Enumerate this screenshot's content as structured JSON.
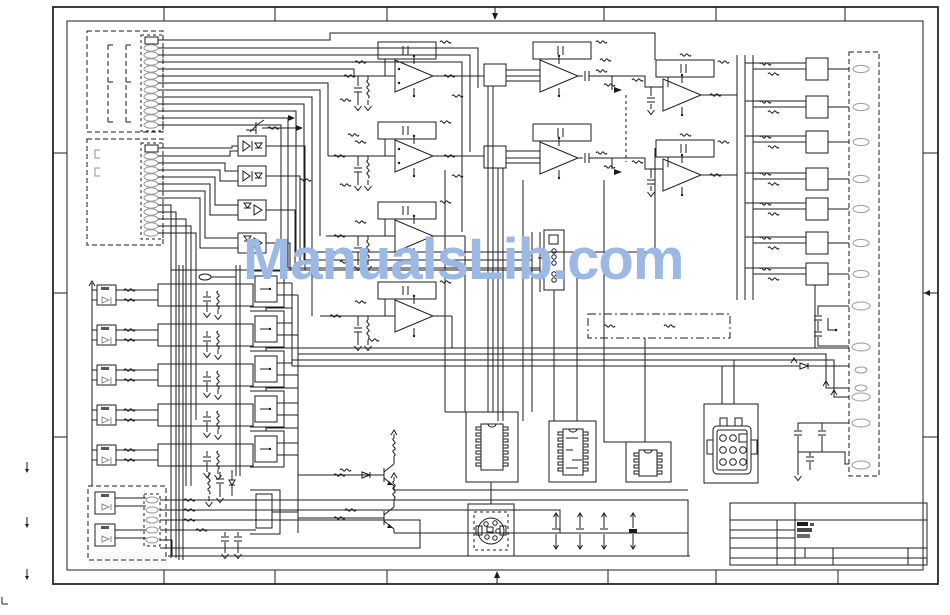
{
  "document": {
    "title": "circuit-wiring-schematic-sheet",
    "watermark": {
      "text": "ManualsLib.com",
      "color": "#9cb9e6"
    },
    "palette": {
      "background": "#ffffff",
      "line": "#1c1c1c",
      "label_marks": "#8f8f8f",
      "pin_outline": "#9a9a9a",
      "watermark_blue": "#9cb9e6"
    }
  },
  "components": {
    "connector_left_top": {
      "kind": "multi-pin-connector-dashed-housing",
      "pins": 13
    },
    "connector_left_mid": {
      "kind": "multi-pin-connector-dashed-housing",
      "pins": 13
    },
    "connector_right_edge": {
      "kind": "edge-connector-dashed-housing",
      "pins": 14
    },
    "connector_bottom_left": {
      "kind": "multi-pin-connector-dashed-housing",
      "pins": 5
    },
    "optocoupler_bank": 4,
    "io_rows": 5,
    "opamps": 8,
    "driver_boxes_right": 7,
    "transistors": 3,
    "ics": [
      "dip-16",
      "dip-16",
      "dip-8"
    ],
    "rect_connector_pins": 12,
    "round_connector_pins": 5,
    "filter_capacitors": 4
  },
  "title_block": {
    "logo": "illegible-dark-stamp",
    "readable_text": false
  }
}
